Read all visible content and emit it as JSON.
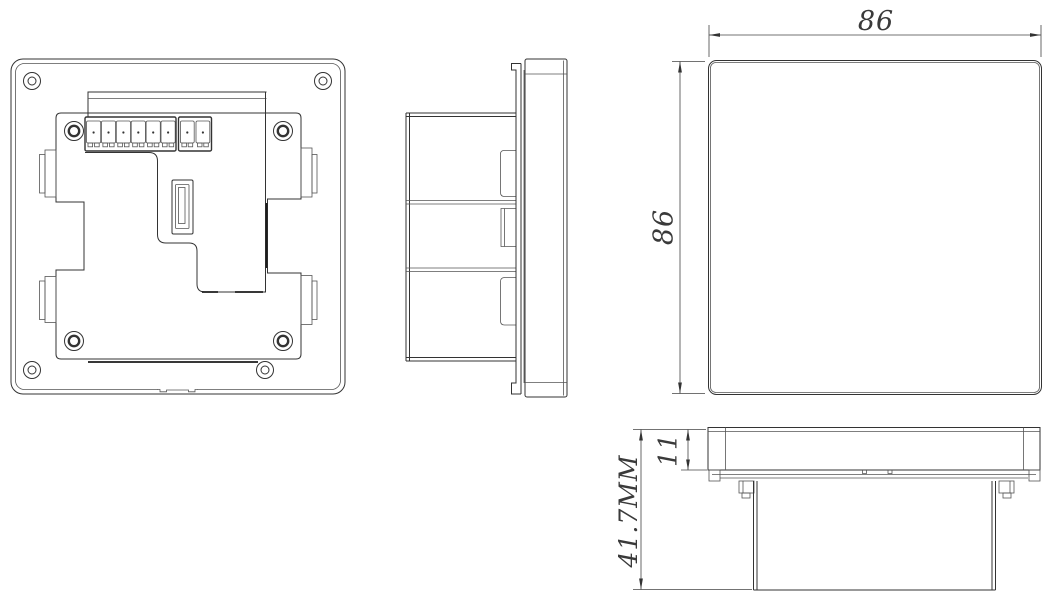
{
  "drawing": {
    "background_color": "#ffffff",
    "line_color": "#333333",
    "dim_text_color": "#3a3a3a",
    "dimensions": {
      "front_width": "86",
      "front_height": "86",
      "panel_thickness": "11",
      "total_depth": "41.7MM"
    },
    "back_view": {
      "terminal_positions_block_a": 6,
      "terminal_positions_block_b": 2,
      "frame_screws": 4,
      "plate_screws": 4
    }
  }
}
